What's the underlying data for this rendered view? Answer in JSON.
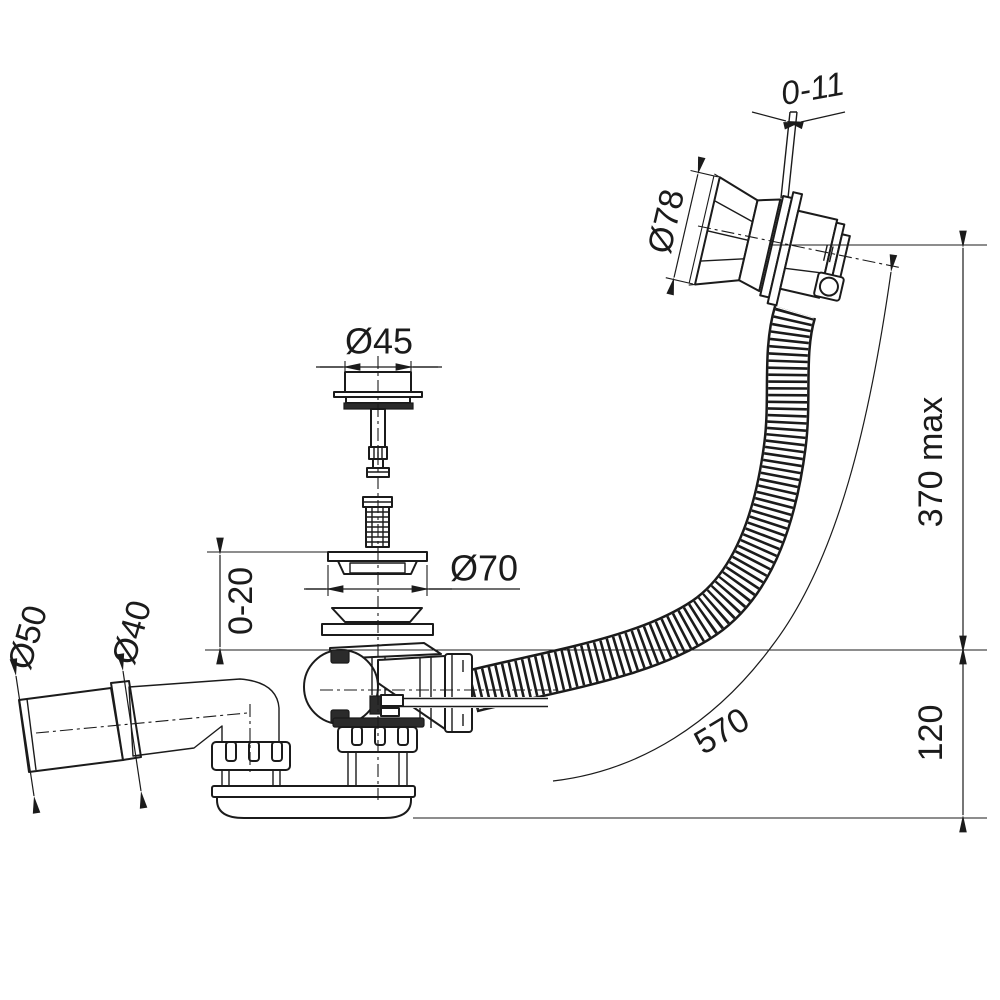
{
  "drawing": {
    "background": "#ffffff",
    "line_color": "#1b1b1b",
    "dimensions": {
      "overflow_cable_adjust": "0-11",
      "overflow_cap_diameter": "Ø78",
      "plug_diameter": "Ø45",
      "waste_flange_diameter": "Ø70",
      "flange_height_adjust": "0-20",
      "outlet_sleeve_diameter": "Ø50",
      "outlet_pipe_diameter": "Ø40",
      "overflow_height_max": "370 max",
      "trap_height": "120",
      "overflow_hose_length": "570"
    }
  }
}
